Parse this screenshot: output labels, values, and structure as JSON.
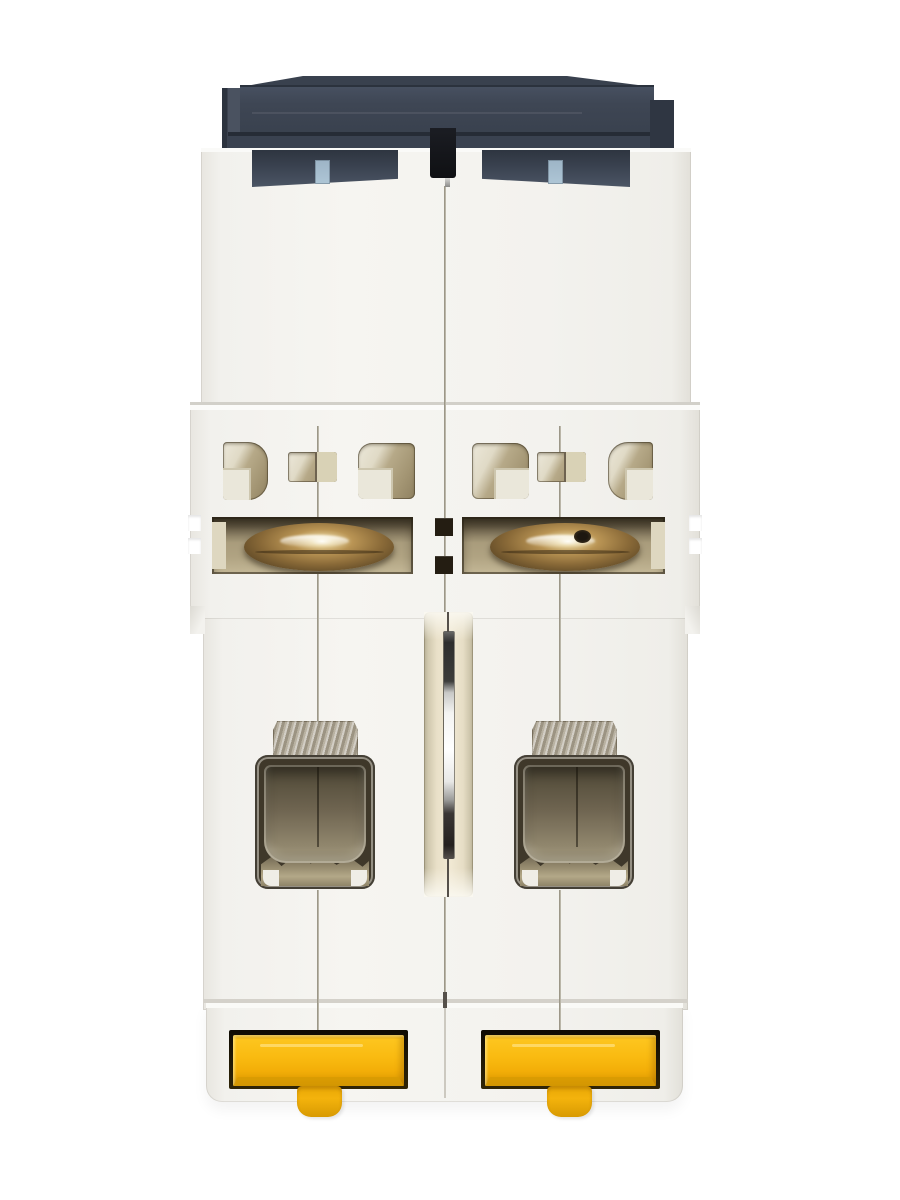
{
  "scene": {
    "description": "Product photograph: rear (DIN-rail mounting) side of a white 2-pole miniature circuit breaker on a white background",
    "background_color": "#ffffff"
  },
  "product": {
    "name": "2-pole miniature circuit breaker, rear view",
    "body_color": "#f3f2ee",
    "parts": {
      "front_housing_cap": {
        "label": "dark front housing (switch side facing away)",
        "color": "#3e4654"
      },
      "indicator_tabs": {
        "label": "light blue coding tabs",
        "count": 2,
        "color": "#a7bfd0"
      },
      "center_notch": {
        "label": "black center slot in housing",
        "color": "#15161a"
      },
      "vent_openings": {
        "label": "ventilation openings",
        "count": 6,
        "interior_color": "#b2a584"
      },
      "coil_windows": {
        "label": "solenoid coil windows",
        "count": 2,
        "coil_color": "#8a6a38"
      },
      "linkage_channel": {
        "label": "central linkage channel with metal pin",
        "interior_color": "#ece3cd",
        "pin_color": "#e8e8e6"
      },
      "terminal_windows": {
        "label": "terminal clamp windows",
        "count": 2,
        "clamp_color": "#6e6450"
      },
      "crimp_plates": {
        "label": "textured metal crimp plates above terminals",
        "count": 2,
        "color": "#b5ae9e"
      },
      "pole_seams": {
        "label": "housing seam lines",
        "count": 3
      },
      "din_clips": {
        "label": "yellow DIN-rail mounting clips",
        "count": 2,
        "color": "#f6b40a"
      }
    }
  }
}
